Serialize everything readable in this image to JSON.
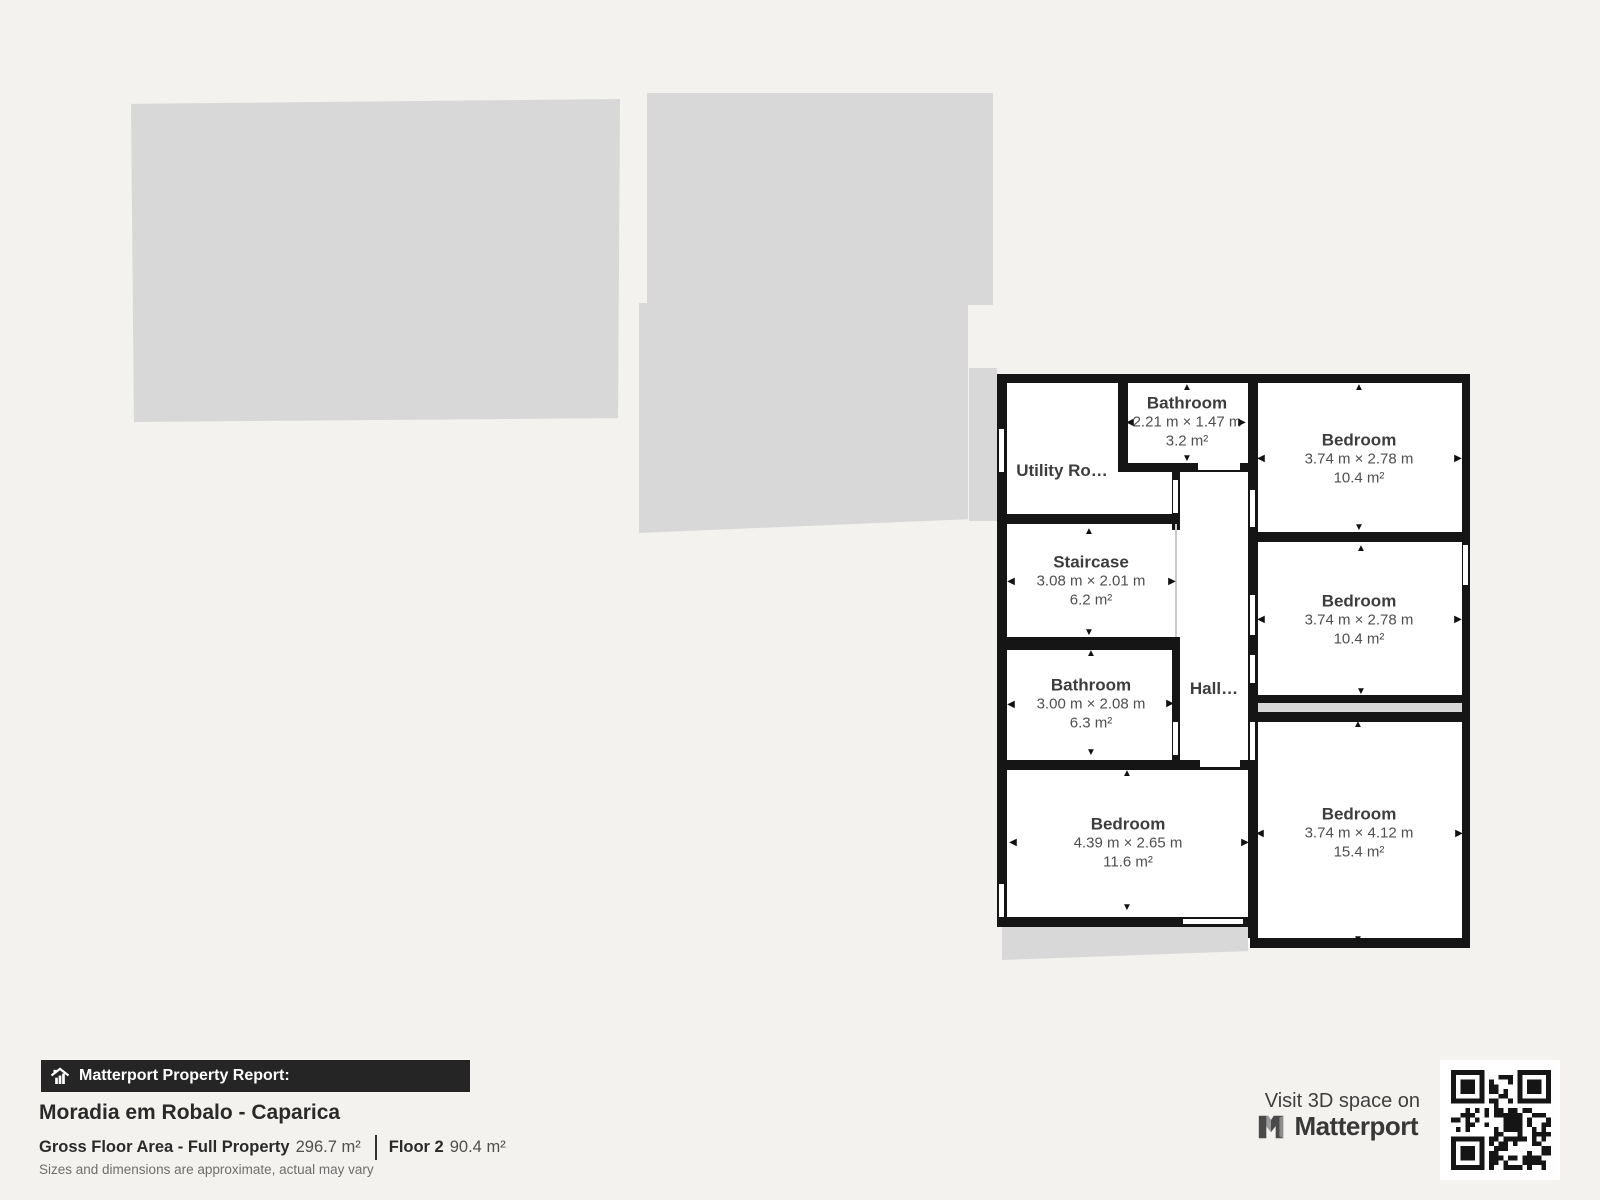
{
  "report": {
    "badge": "Matterport Property Report:",
    "title": "Moradia em Robalo - Caparica",
    "gfa_label": "Gross Floor Area - Full Property",
    "gfa_value": "296.7 m²",
    "floor_label": "Floor 2",
    "floor_value": "90.4 m²",
    "disclaimer": "Sizes and dimensions are approximate, actual may vary"
  },
  "cta": {
    "line": "Visit 3D space on",
    "brand": "Matterport"
  },
  "colors": {
    "background": "#f3f2ef",
    "other_floor_gray": "#d8d8d8",
    "wall": "#151515",
    "room_fill": "#ffffff",
    "room_name_text": "#3d3d3d",
    "room_dims_text": "#4f4f4f"
  },
  "floorplan": {
    "rooms": [
      {
        "name": "Bathroom",
        "dims": "2.21 m × 1.47 m",
        "area": "3.2 m²",
        "cx": 1187,
        "cy": 422,
        "arrows": {
          "up": [
            1187,
            388
          ],
          "down": [
            1187,
            459
          ],
          "left": [
            1130,
            423
          ],
          "right": [
            1242,
            423
          ]
        }
      },
      {
        "name": "Bedroom",
        "dims": "3.74 m × 2.78 m",
        "area": "10.4 m²",
        "cx": 1359,
        "cy": 459,
        "arrows": {
          "up": [
            1359,
            388
          ],
          "down": [
            1359,
            528
          ],
          "left": [
            1261,
            459
          ],
          "right": [
            1458,
            459
          ]
        }
      },
      {
        "name": "Bedroom",
        "dims": "3.74 m × 2.78 m",
        "area": "10.4 m²",
        "cx": 1359,
        "cy": 620,
        "arrows": {
          "up": [
            1361,
            549
          ],
          "down": [
            1361,
            692
          ],
          "left": [
            1261,
            620
          ],
          "right": [
            1458,
            620
          ]
        }
      },
      {
        "name": "Bedroom",
        "dims": "3.74 m × 4.12 m",
        "area": "15.4 m²",
        "cx": 1359,
        "cy": 833,
        "arrows": {
          "up": [
            1358,
            725
          ],
          "down": [
            1358,
            940
          ],
          "left": [
            1260,
            834
          ],
          "right": [
            1459,
            834
          ]
        }
      },
      {
        "name": "Staircase",
        "dims": "3.08 m × 2.01 m",
        "area": "6.2 m²",
        "cx": 1091,
        "cy": 581,
        "arrows": {
          "up": [
            1089,
            532
          ],
          "down": [
            1089,
            633
          ],
          "left": [
            1011,
            582
          ],
          "right": [
            1172,
            582
          ]
        }
      },
      {
        "name": "Bathroom",
        "dims": "3.00 m × 2.08 m",
        "area": "6.3 m²",
        "cx": 1091,
        "cy": 704,
        "arrows": {
          "up": [
            1091,
            654
          ],
          "down": [
            1091,
            753
          ],
          "left": [
            1011,
            705
          ],
          "right": [
            1170,
            704
          ]
        }
      },
      {
        "name": "Bedroom",
        "dims": "4.39 m × 2.65 m",
        "area": "11.6 m²",
        "cx": 1128,
        "cy": 843,
        "arrows": {
          "up": [
            1127,
            774
          ],
          "down": [
            1127,
            908
          ],
          "left": [
            1013,
            843
          ],
          "right": [
            1245,
            843
          ]
        }
      }
    ],
    "plain_labels": [
      {
        "name": "utility-room-label",
        "text": "Utility Ro…",
        "x": 1062,
        "y": 471
      },
      {
        "name": "hall-label",
        "text": "Hall…",
        "x": 1214,
        "y": 689
      }
    ]
  }
}
